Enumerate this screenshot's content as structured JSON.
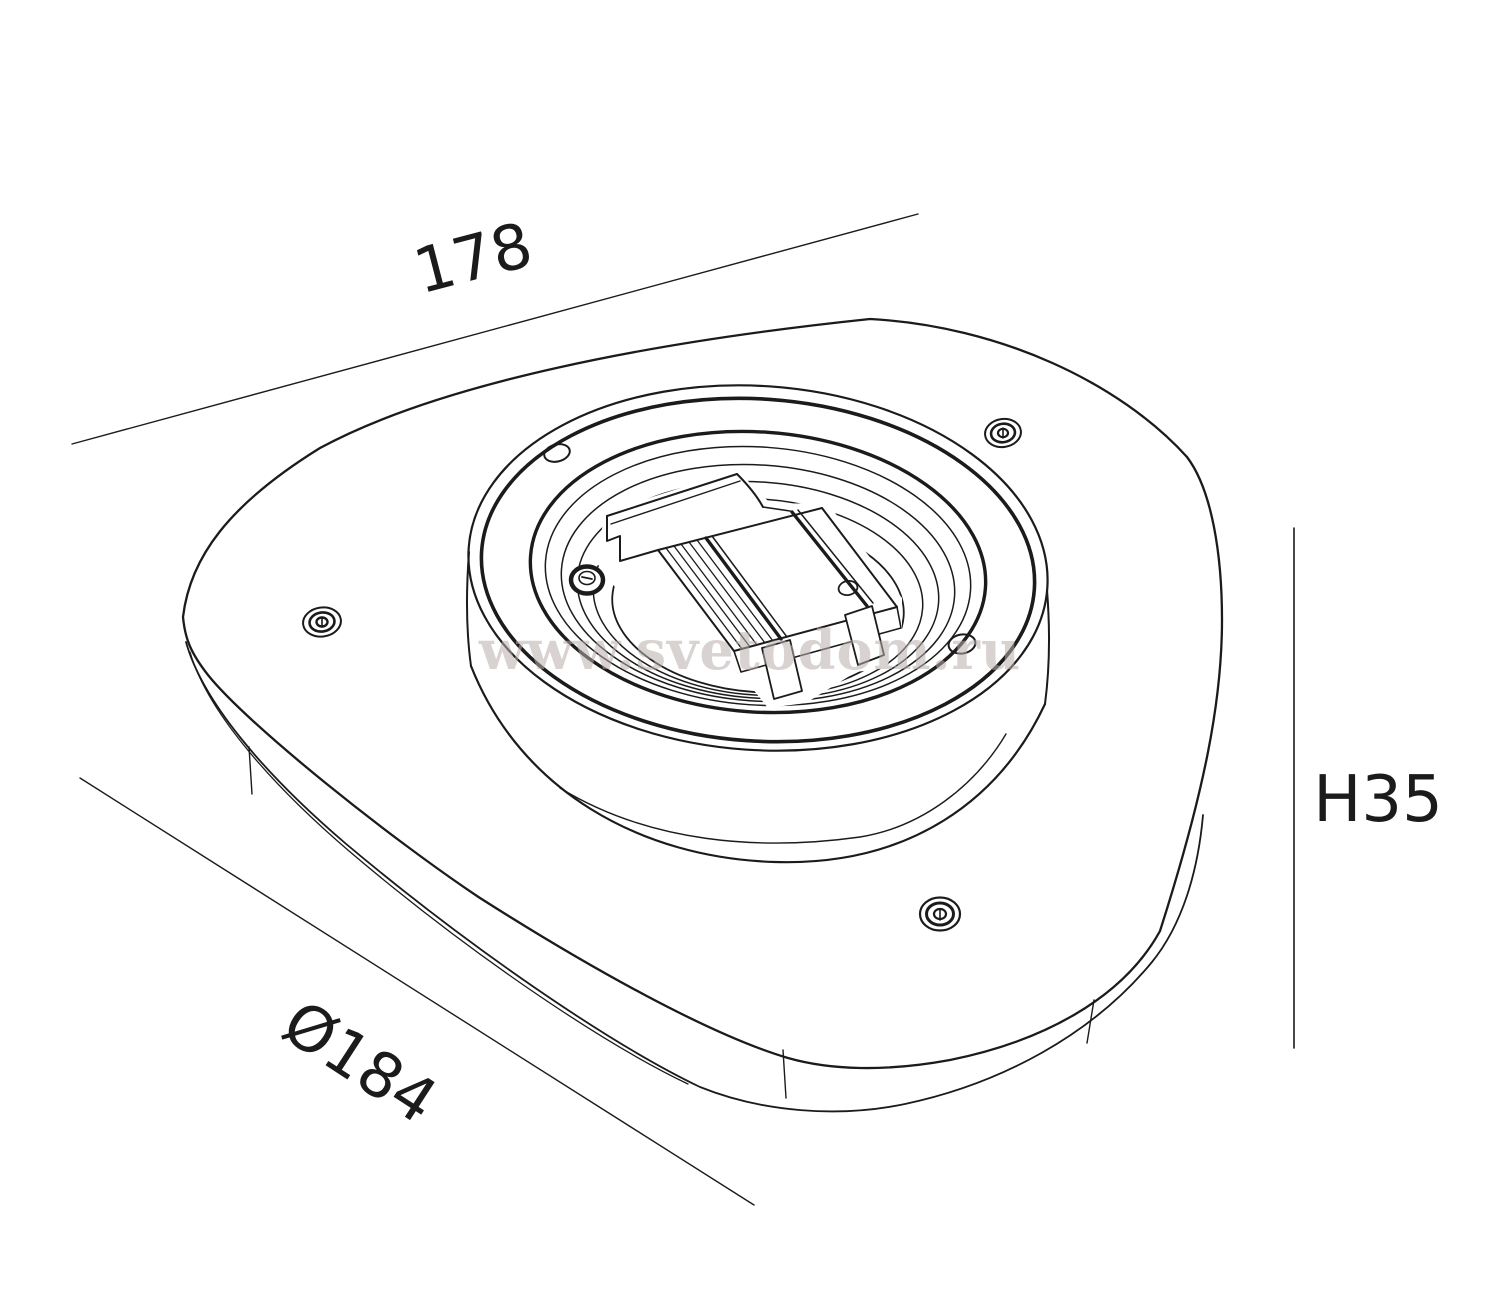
{
  "drawing": {
    "type": "isometric technical line drawing of a round-triangular light fixture mounting plate with central threaded ring and gear bracket",
    "stroke_color": "#1b1b1b",
    "background_color": "#ffffff",
    "watermark": {
      "text": "www.svetodom.ru",
      "color": "#b9aeab"
    },
    "dimensions": {
      "width": {
        "label": "178",
        "orientation": "diagonal-top"
      },
      "diameter": {
        "label": "Ø184",
        "orientation": "diagonal-bottom-left"
      },
      "height": {
        "label": "H35",
        "orientation": "vertical-right"
      }
    }
  }
}
